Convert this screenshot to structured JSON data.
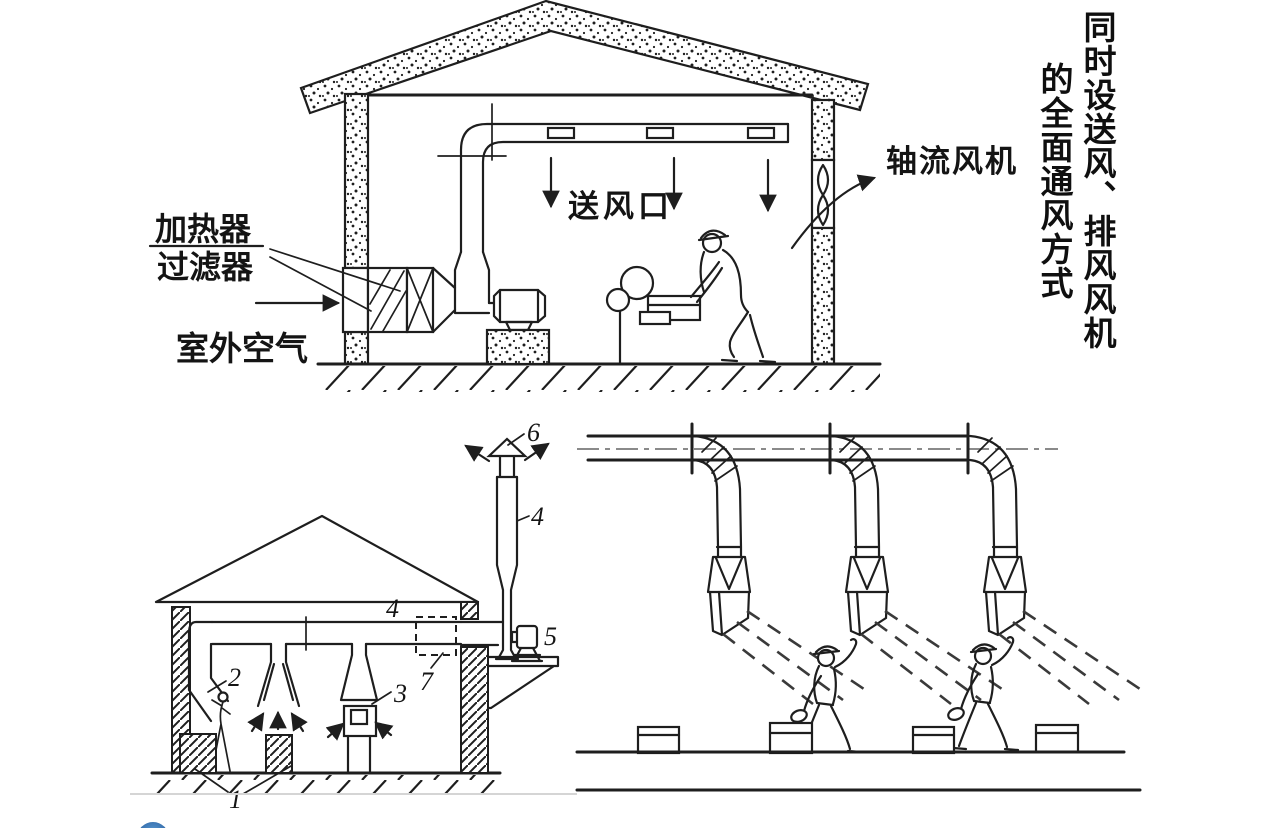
{
  "title_vertical": {
    "line1": "同时设送风、排风风机",
    "line2": "的全面通风方式"
  },
  "top_diagram": {
    "labels": {
      "heater": "加热器",
      "filter": "过滤器",
      "outdoor_air": "室外空气",
      "supply_outlet": "送风口",
      "axial_fan": "轴流风机"
    }
  },
  "bottom_left_diagram": {
    "callouts": {
      "c1": "1",
      "c2": "2",
      "c3": "3",
      "c4_duct": "4",
      "c4_stack": "4",
      "c5": "5",
      "c6": "6",
      "c7": "7"
    }
  },
  "colors": {
    "ink": "#1e1e1e",
    "centerline": "#8a8a8a",
    "separator": "#d5d5d5",
    "logo_blue": "#2e6cb5"
  }
}
